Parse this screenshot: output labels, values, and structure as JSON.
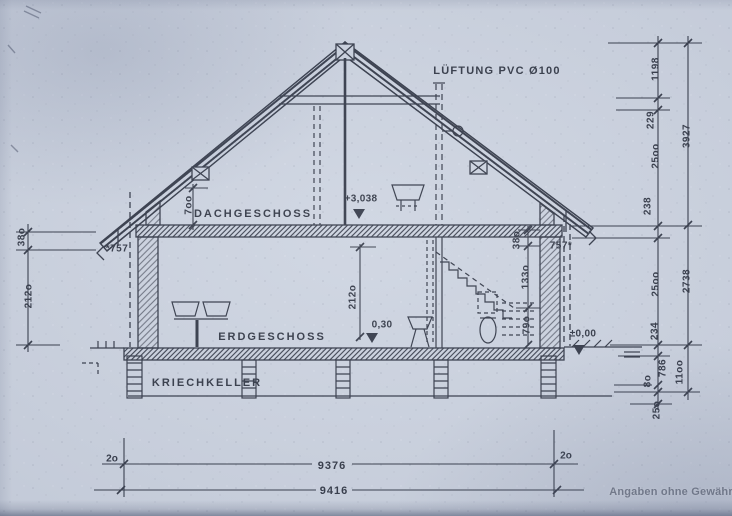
{
  "note": "Angaben ohne Gewähr",
  "labels": {
    "vent": "LÜFTUNG PVC Ø100",
    "attic": "DACHGESCHOSS",
    "ground": "ERDGESCHOSS",
    "crawl": "KRIECHKELLER"
  },
  "levels": {
    "attic_floor": "+3,038",
    "ground_offset": "0,30",
    "zero": "±0,00"
  },
  "dims": {
    "left": {
      "slab": "38o",
      "storey": "212o",
      "eaves": "*757",
      "knee": "7oo"
    },
    "center": {
      "room_height": "212o"
    },
    "stairs": {
      "top": "38o",
      "mid": "133o",
      "low": "79o"
    },
    "right_eaves": "757*",
    "right_inner": [
      "1198",
      "229",
      "25oo",
      "238",
      "25oo",
      "234",
      "786",
      "8o",
      "25o"
    ],
    "right_outer": [
      "3927",
      "2738",
      "11oo"
    ],
    "bottom": {
      "offset_left": "2o",
      "span_inner": "9376",
      "offset_right": "2o",
      "span_outer": "9416"
    }
  }
}
